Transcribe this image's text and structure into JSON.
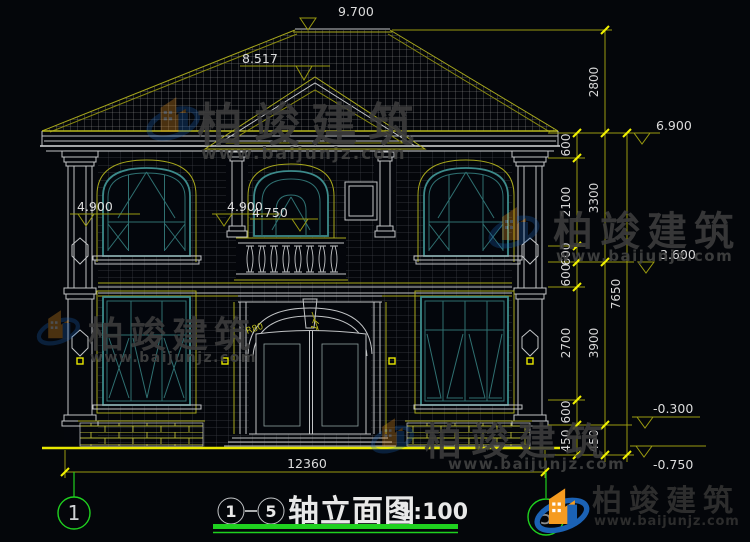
{
  "drawing_title": {
    "axis_start": "1",
    "axis_end": "5",
    "name": "轴立面图",
    "scale": "1:100"
  },
  "axis_bubbles": {
    "left": "1",
    "right": "5"
  },
  "elevations": {
    "ridge": "9.700",
    "gable": "8.517",
    "eave_right": "6.900",
    "upper_floor_right": "3.600",
    "plinth_right": "-0.300",
    "ground_right": "-0.750",
    "left_column_top": "4.900",
    "center_window_top": "4.900",
    "center_window_sub": "4.750"
  },
  "dimensions": {
    "right_inner": [
      "600",
      "2100",
      "600",
      "600",
      "2700",
      "600",
      "450"
    ],
    "right_middle": [
      "2800",
      "3300",
      "3900",
      "450"
    ],
    "right_overall": "7650",
    "bottom_overall": "12360"
  },
  "arch_annotations": {
    "radius_left": "R80",
    "radius_right": "R5017"
  },
  "watermark": {
    "brand": "柏竣建筑",
    "website": "www.baijunjz.com"
  },
  "logo": {
    "brand": "柏竣建筑",
    "website": "www.baijunjz.com"
  },
  "colors": {
    "background": "#04060a",
    "linework": "#c2c4c6",
    "window_frame": "#3d8b8b",
    "dimension_line": "#9a9a10",
    "tick": "#f2f200",
    "axis_green": "#1fd11f",
    "watermark_text": "#3c3c3c",
    "logo_blue": "#1b62b5",
    "logo_orange": "#f59b20"
  }
}
